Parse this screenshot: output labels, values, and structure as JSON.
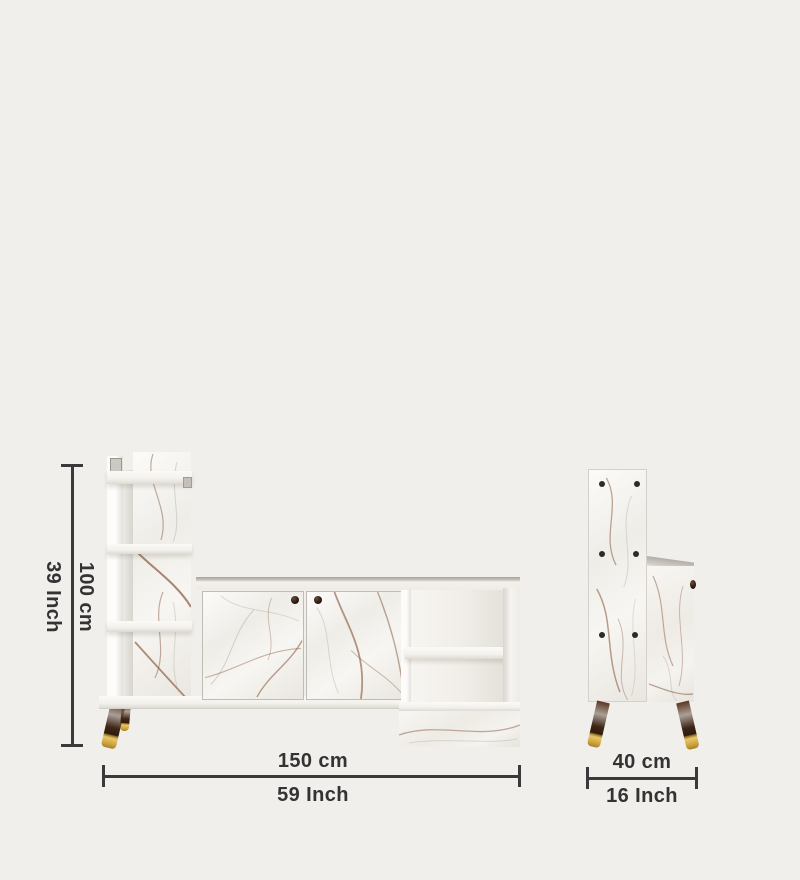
{
  "page": {
    "background_color": "#f0efec"
  },
  "annotations": {
    "height": {
      "cm": "100 cm",
      "inch": "39 Inch"
    },
    "width": {
      "cm": "150 cm",
      "inch": "59 Inch"
    },
    "depth": {
      "cm": "40 cm",
      "inch": "16 Inch"
    }
  },
  "colors": {
    "dimension_line": "#3a3a3a",
    "label_text": "#333333",
    "furniture_white": "#f8f6f2",
    "marble_vein": "#8d6148",
    "leg_wood": "#3c2416",
    "leg_brass_tip": "#d8ab4a"
  }
}
